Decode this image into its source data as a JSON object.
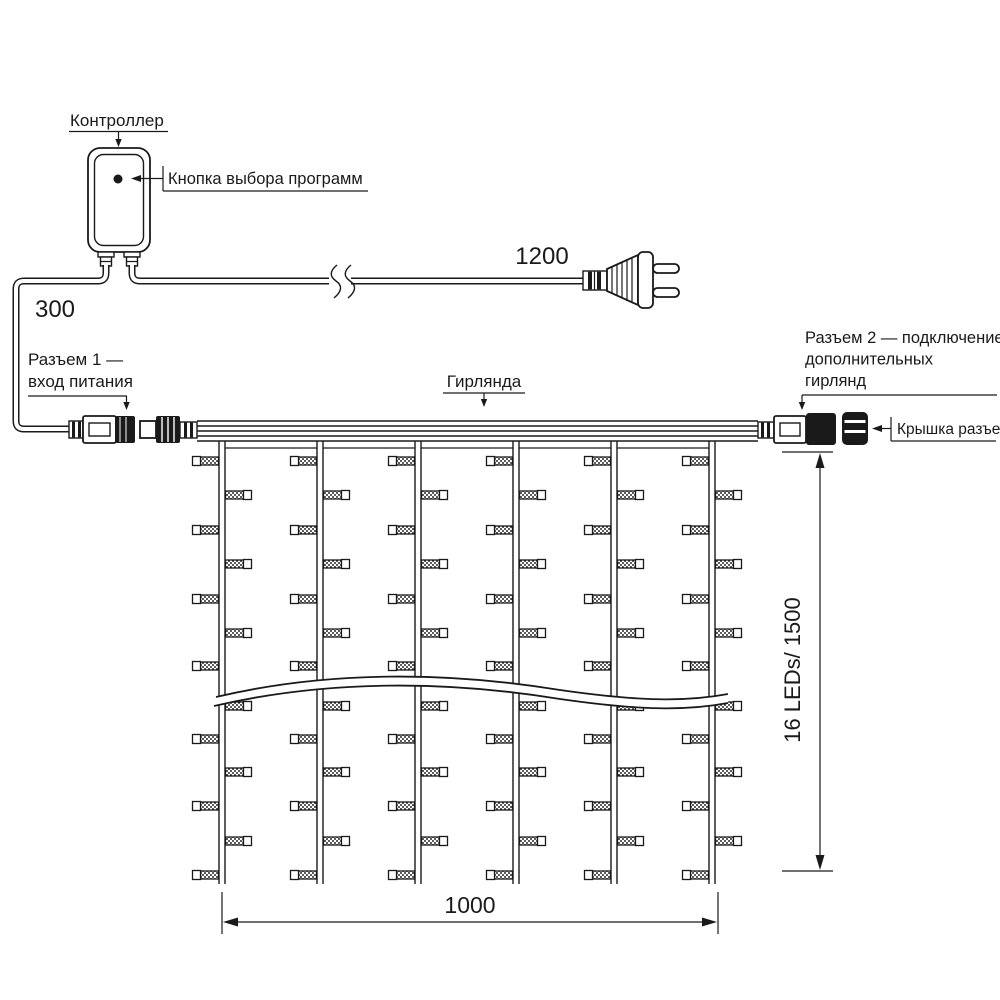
{
  "page": {
    "background": "#ffffff",
    "line_color": "#1a1a1a",
    "type": "technical-diagram",
    "subject": "LED curtain garland wiring diagram with controller, power plug and connectors"
  },
  "labels": {
    "controller": "Контроллер",
    "program_button": "Кнопка выбора программ",
    "power_cord_length": "1200",
    "controller_cord_length": "300",
    "connector1_line1": "Разъем 1 —",
    "connector1_line2": "вход питания",
    "garland": "Гирлянда",
    "connector2_line1": "Разъем 2 — подключение",
    "connector2_line2": "дополнительных",
    "connector2_line3": "гирлянд",
    "connector_cap": "Крышка разъема",
    "height_dimension": "16 LEDs/ 1500",
    "width_dimension": "1000"
  },
  "curtain": {
    "strings_count": 6,
    "strings_x": [
      222,
      320,
      418,
      516,
      614,
      712
    ],
    "half_gap": 3,
    "top_y": 441,
    "bottom_y": 884,
    "gap_link_y": 448,
    "visible_led_rows": 13,
    "led_rows_y": [
      461,
      495,
      530,
      564,
      599,
      633,
      666,
      706,
      739,
      772,
      806,
      841,
      875
    ],
    "first_led_side": "left",
    "led": {
      "body_len": 18,
      "body_h": 8,
      "cap_w": 8,
      "cap_h": 9
    },
    "leds_per_drop_labeled": 16,
    "drop_length_labeled_mm": 1500,
    "width_labeled_mm": 1000
  }
}
